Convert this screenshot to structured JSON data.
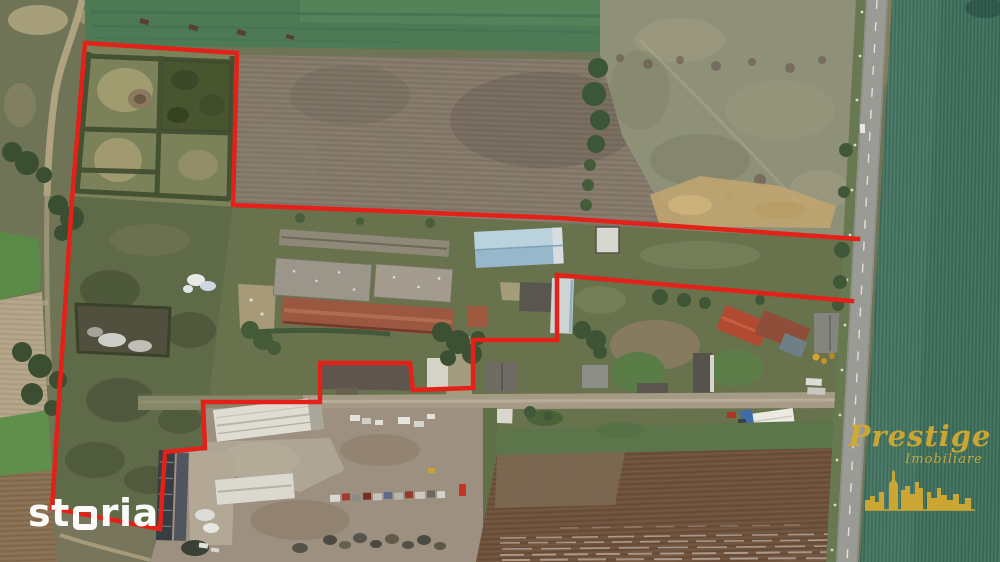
{
  "image": {
    "kind": "aerial-drone-photo",
    "description": "Drone aerial view of a rural farm property for sale; red polyline marks the plot boundary around gardens, barns and a farmyard, with a paved road and a large green crop field on the right.",
    "width_px": 1000,
    "height_px": 562
  },
  "boundary": {
    "color": "#e32119",
    "stroke_width": 4.5,
    "points": "858,239 560,218 233,205 237,53 85,43 72,200 52,508 160,529 165,452 205,448 203,402 320,402 320,363 410,363 413,390 473,388 473,340 557,340 557,275 852,301"
  },
  "watermarks": {
    "storia": {
      "text": "storia",
      "part1": "st",
      "part2": "ria",
      "color": "#ffffff"
    },
    "prestige": {
      "line1": "Prestige",
      "line2": "Imobiliare",
      "color": "#d3a930"
    }
  },
  "scene": {
    "palette": {
      "crop_field_green": "#3e6f5c",
      "plowed_field_top": "#85796a",
      "plowed_field_bottom": "#6f523c",
      "pale_pasture": "#8e9078",
      "scrub_grass": "#6f7457",
      "road_asphalt": "#9a9b95",
      "dirt_track": "#b5a786",
      "barn_red_roof": "#9b5740",
      "warehouse_blue_roof": "#a8c6d6"
    },
    "features": [
      "garden-plots-with-hedges",
      "plowed-field",
      "pasture",
      "long-barns",
      "blue-roof-warehouse",
      "farm-houses",
      "white-industrial-buildings",
      "dark-greenhouse-tunnels",
      "junk-vehicle-rows",
      "field-road",
      "paved-road-with-dashed-line",
      "utility-poles",
      "green-crop-field"
    ]
  }
}
